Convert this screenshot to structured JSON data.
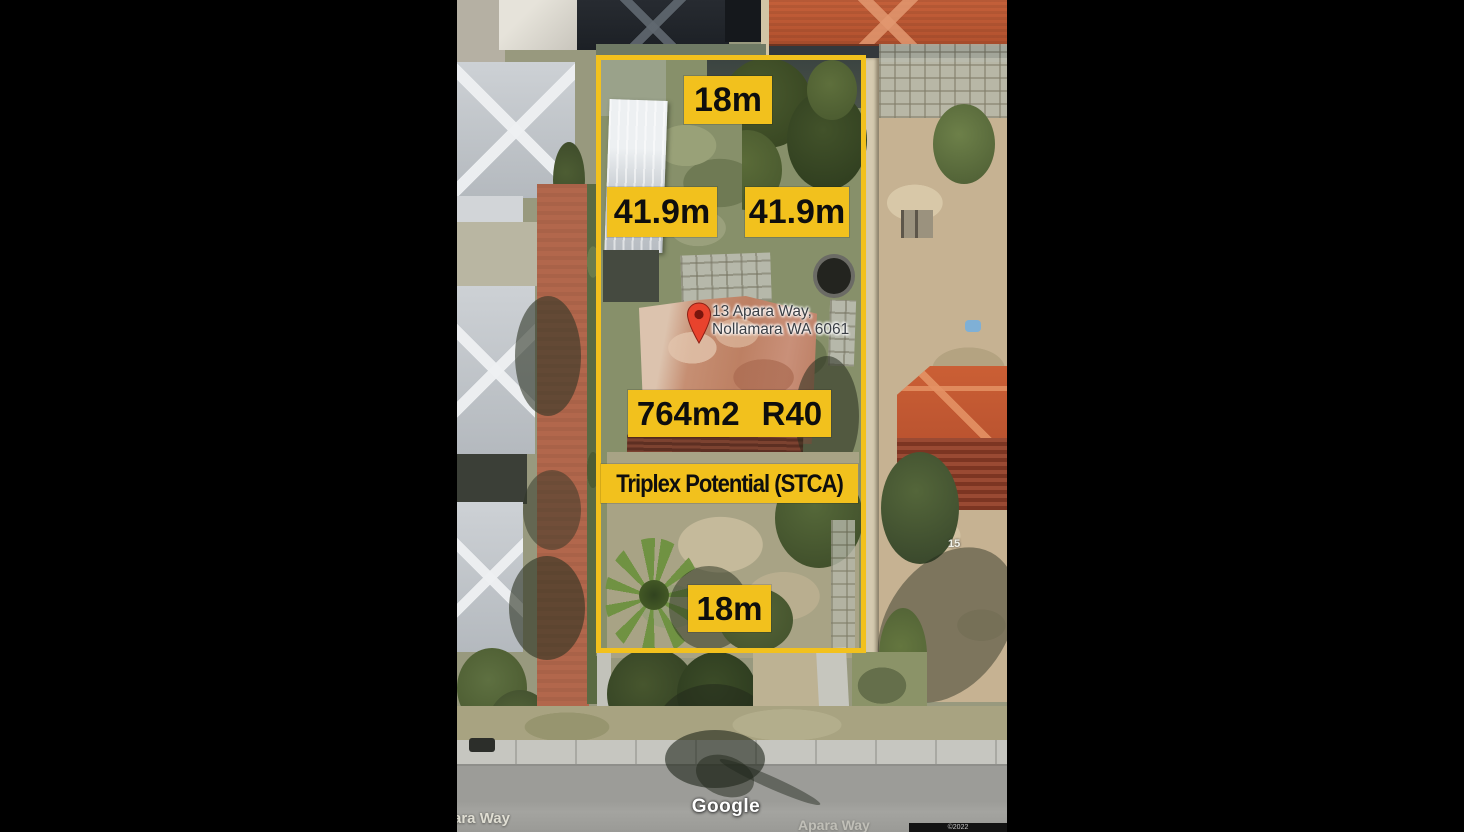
{
  "window": {
    "background": "#000000"
  },
  "map": {
    "watermark": "Google",
    "street_labels": {
      "left_partial": "ara Way",
      "right_faint": "Apara Way"
    },
    "neighbor_house_number": "15",
    "attribution": "©2022"
  },
  "overlay": {
    "accent_color": "#F2C11D",
    "text_color": "#0E0E0E",
    "labels": {
      "top_width": "18m",
      "left_length": "41.9m",
      "right_length": "41.9m",
      "area": "764m2",
      "zoning": "R40",
      "potential": "Triplex Potential (STCA)",
      "bottom_width": "18m"
    },
    "pin": {
      "color": "#E8432D",
      "address_line1": "13 Apara Way,",
      "address_line2": "Nollamara WA 6061"
    }
  }
}
